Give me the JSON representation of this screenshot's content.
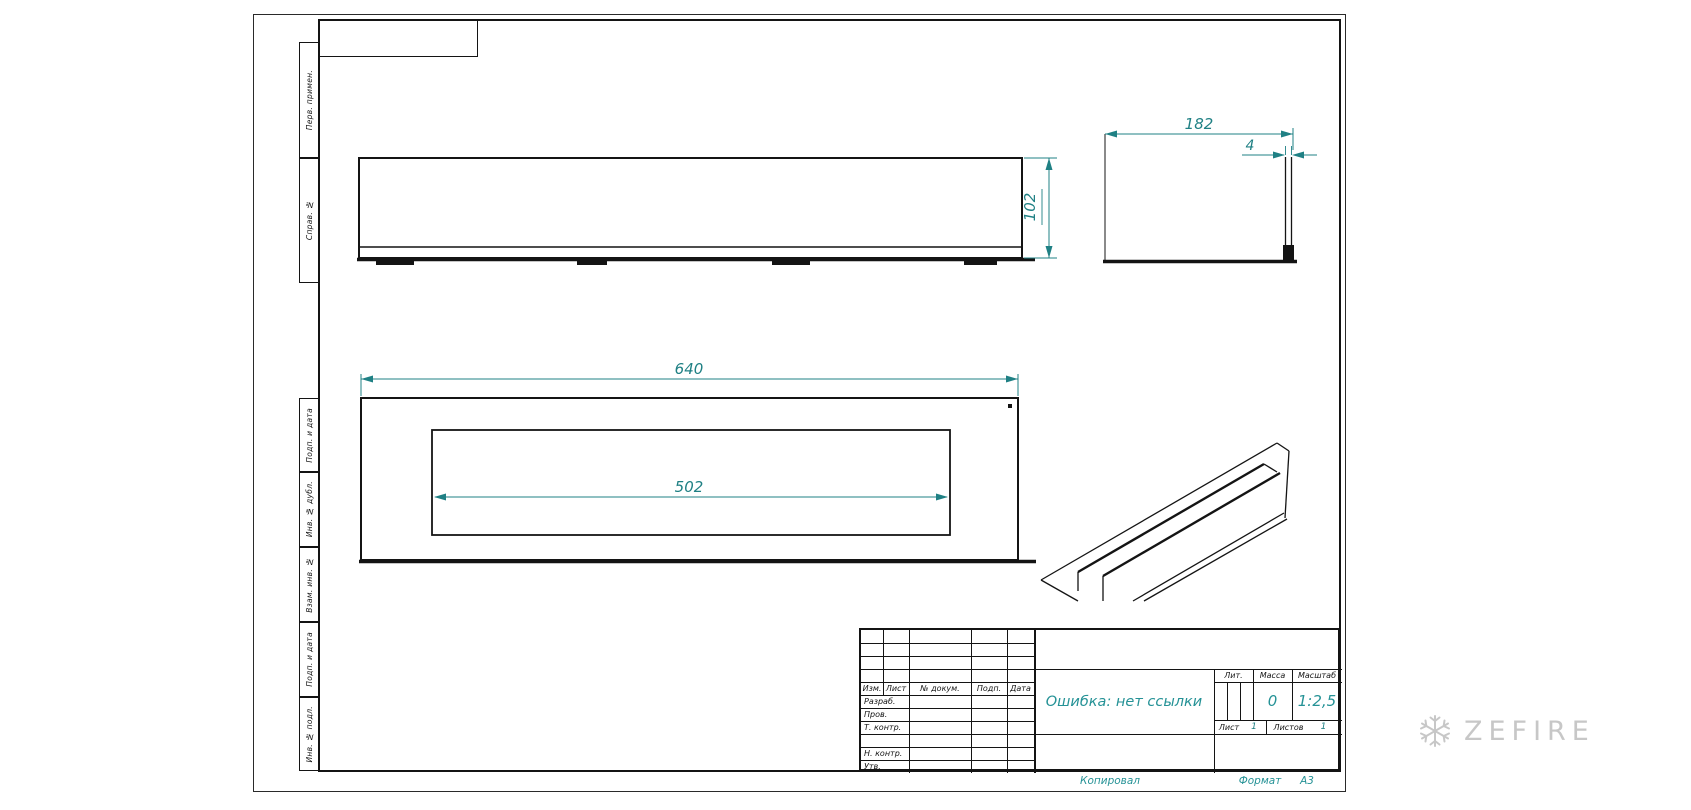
{
  "colors": {
    "line": "#141414",
    "dim": "#1f8084",
    "accent": "#259296",
    "watermark": "#c7c7c7"
  },
  "dims": {
    "height": "102",
    "depth": "182",
    "thickness": "4",
    "width": "640",
    "opening": "502"
  },
  "side_strip": {
    "top": [
      "Перв. примен.",
      "Справ. №"
    ],
    "bottom": [
      "Подп. и дата",
      "Инв. № дубл.",
      "Взам. инв. №",
      "Подп. и дата",
      "Инв. № подл."
    ]
  },
  "title_block": {
    "header": [
      "Изм.",
      "Лист",
      "№ докум.",
      "Подп.",
      "Дата"
    ],
    "rows": [
      "Разраб.",
      "Пров.",
      "Т. контр.",
      "",
      "Н. контр.",
      "Утв."
    ],
    "name": "Ошибка: нет ссылки",
    "lit": "Лит.",
    "mass": "Масса",
    "scale": "Масштаб",
    "mass_value": "0",
    "scale_value": "1:2,5",
    "sheet": "Лист",
    "sheet_value": "1",
    "sheets": "Листов",
    "sheets_value": "1"
  },
  "footer": {
    "copied": "Копировал",
    "format": "Формат",
    "format_value": "А3"
  },
  "watermark": {
    "brand": "ZEFIRE",
    "icon": "snowflake-icon"
  }
}
